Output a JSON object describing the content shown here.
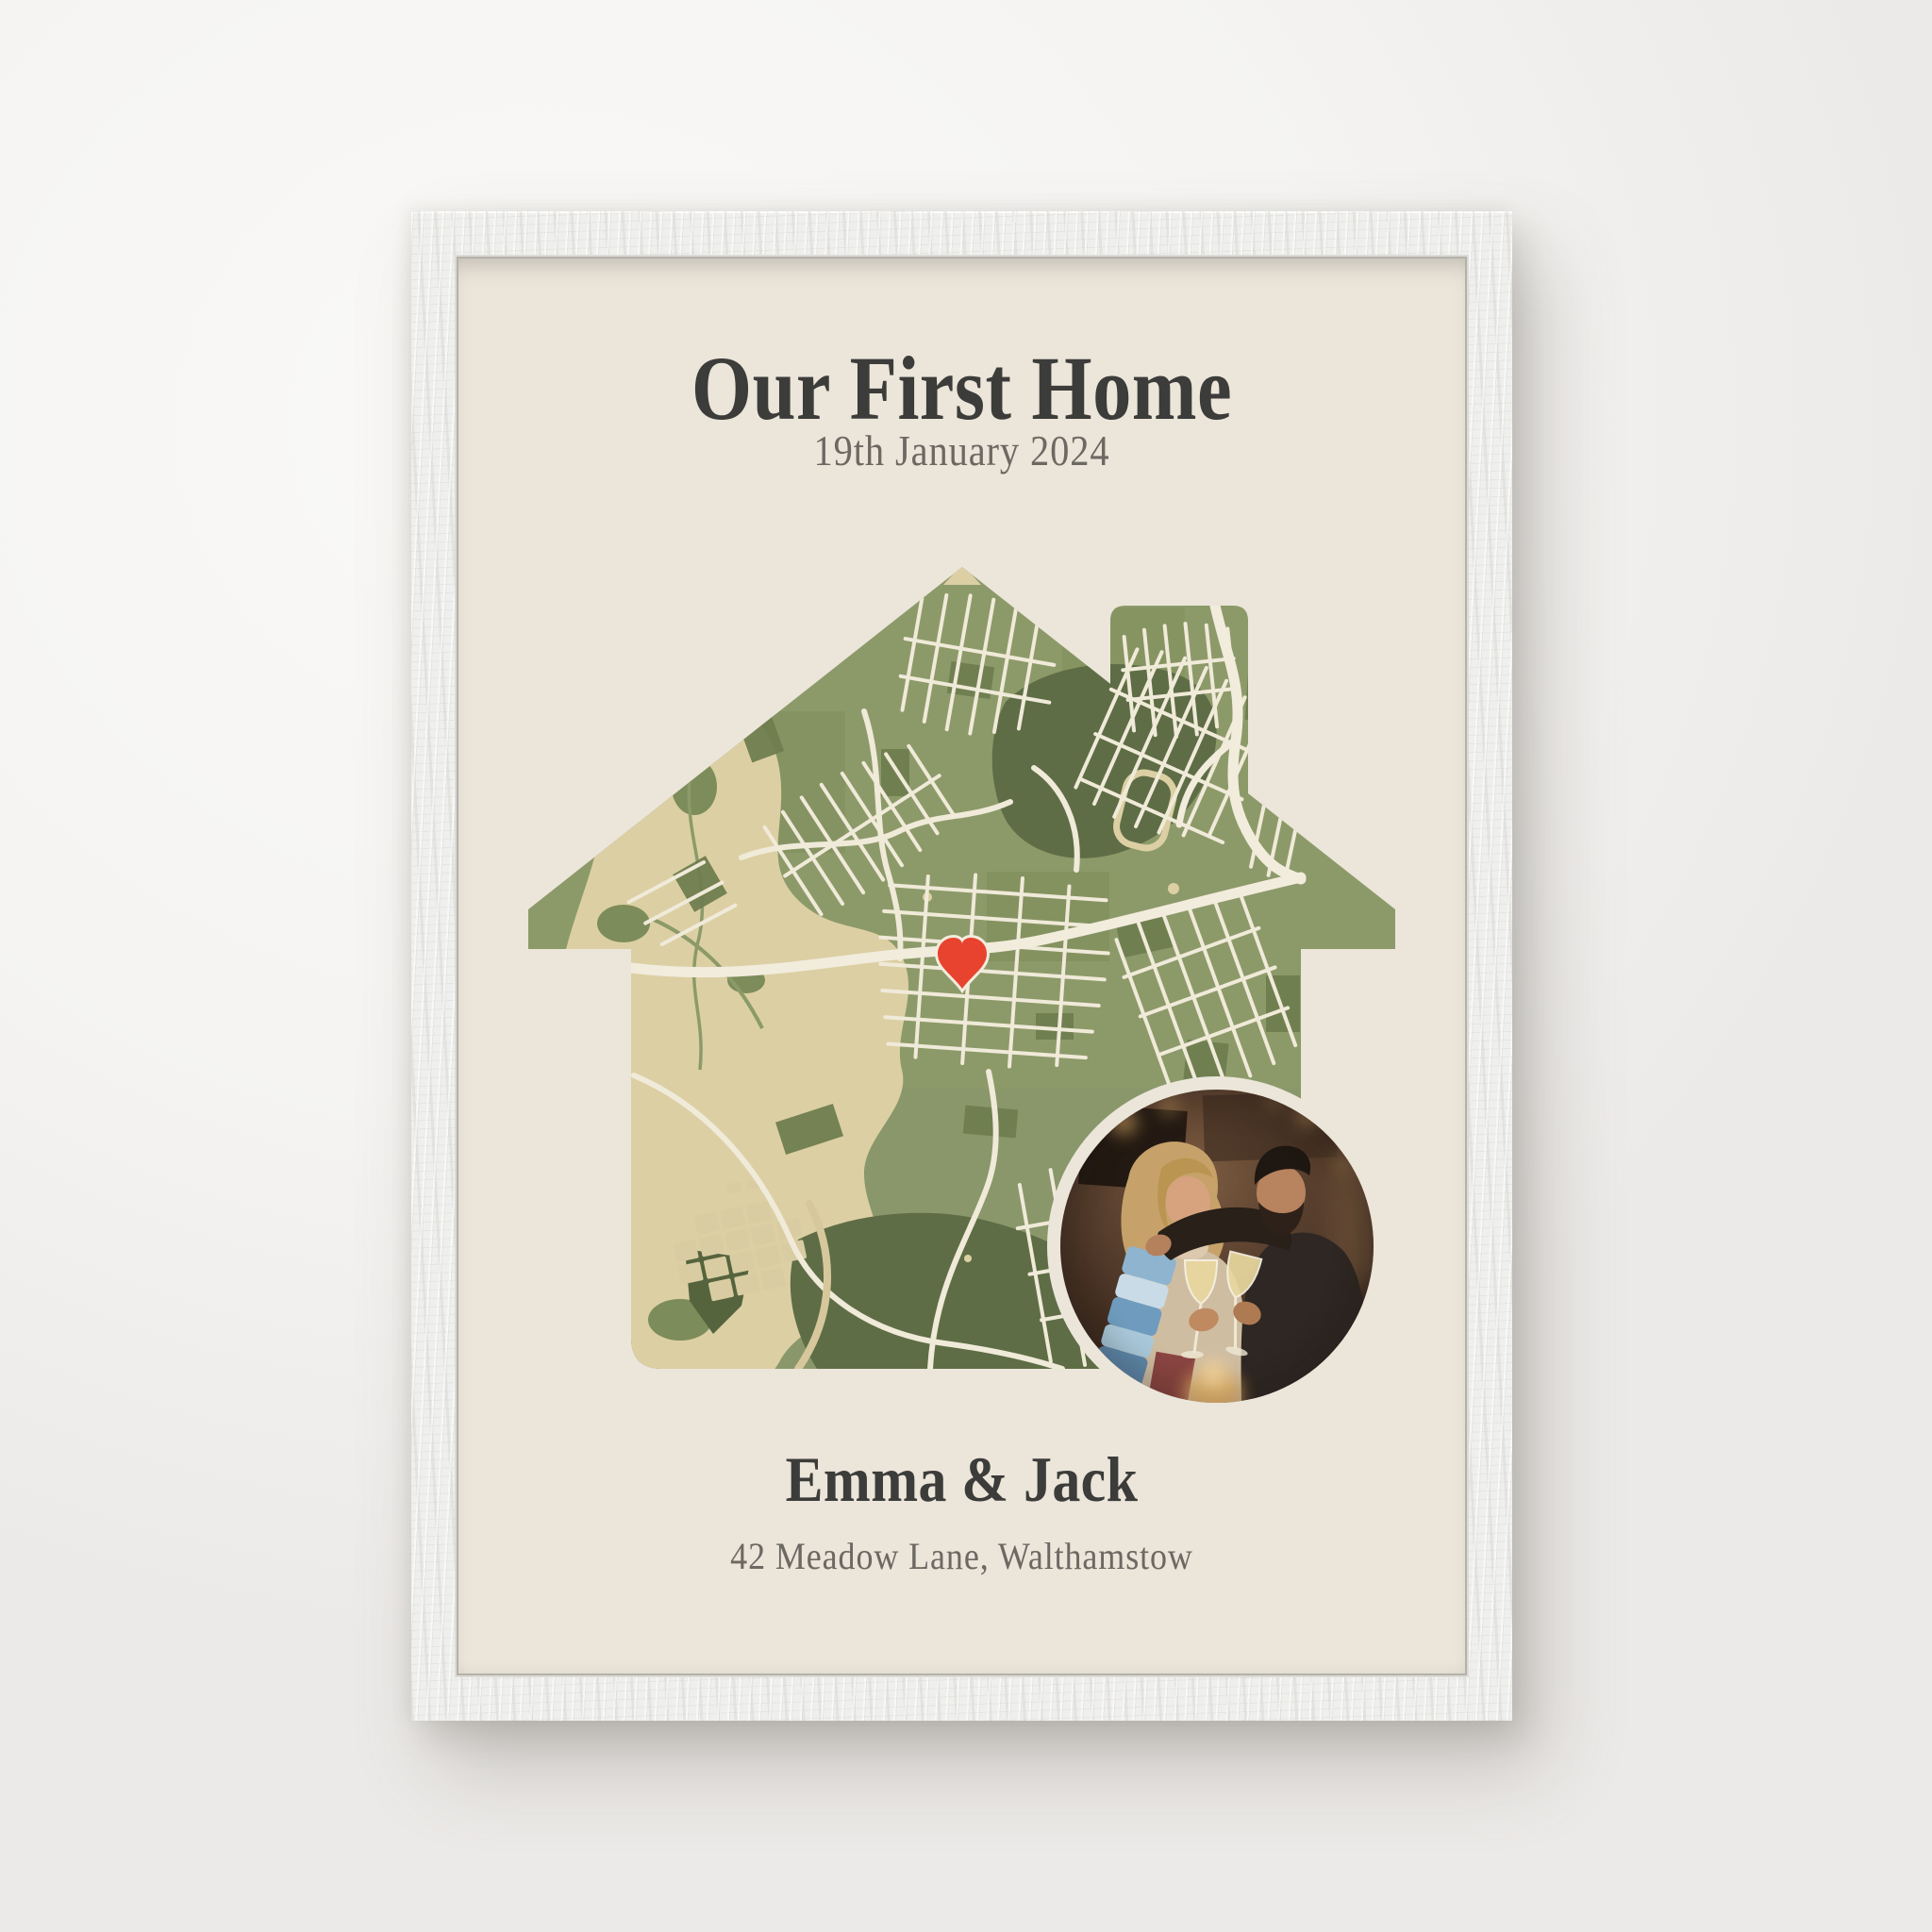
{
  "poster": {
    "title": "Our First Home",
    "subtitle": "19th January 2024",
    "names": "Emma & Jack",
    "address": "42 Meadow Lane, Walthamstow",
    "background": "#ebe5da",
    "colors": {
      "heading_text": "#3c3c3a",
      "muted_text": "#6c6862",
      "map_green": "#8c9a69",
      "map_green_mid": "#6f7e50",
      "map_green_dark": "#5e6d45",
      "map_park_beige": "#dccfa4",
      "map_road_cream": "#f0ead9",
      "marker_red": "#e8432e",
      "frame_white": "#efefed"
    },
    "map": {
      "shape": "house-with-chimney",
      "marker_icon": "heart-marker-icon",
      "photo": "couple-toasting-photo"
    }
  }
}
